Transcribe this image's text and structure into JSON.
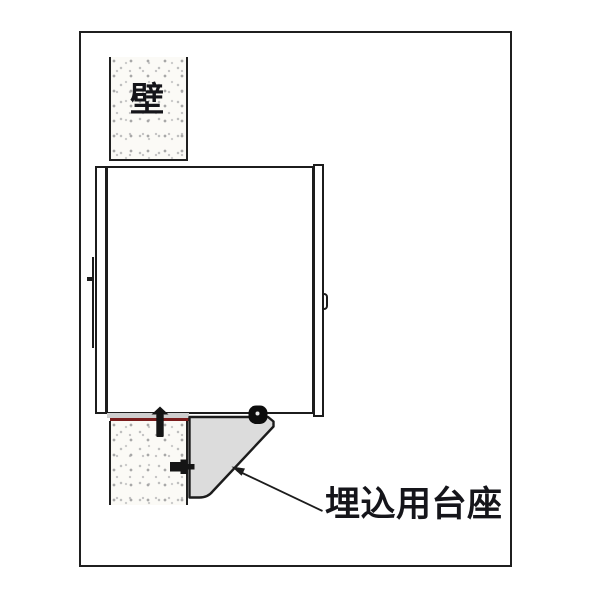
{
  "diagram": {
    "labels": {
      "wall": "壁",
      "pedestal": "埋込用台座"
    },
    "colors": {
      "line": "#1c1c1c",
      "pedestal_fill": "#dcdcdc",
      "packing_red": "#7b1d1d",
      "wall_fill": "#fbfaf6",
      "wall_speckle": "#b3b3b3",
      "background": "#ffffff"
    }
  }
}
